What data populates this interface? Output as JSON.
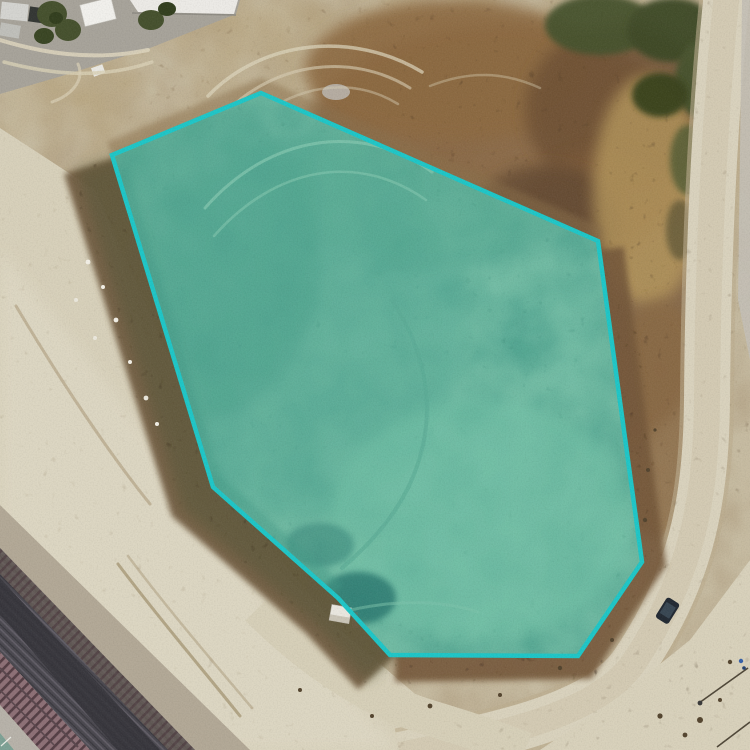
{
  "map": {
    "view": "aerial-orthophoto",
    "overlay": {
      "label": "highlighted-parcel",
      "shape": "polygon",
      "vertex_count": 8,
      "points": "261,93 598,241 642,562 578,656 390,655 338,598 213,487 112,155",
      "stroke_color": "#1fc6c7",
      "stroke_width": 4.5,
      "fill_color": "#2ec8bf",
      "fill_opacity": 0.28
    },
    "palette": {
      "sand": "#d7d0ba",
      "dirt": "#c6bba1",
      "scrub_brown": "#7c5c3b",
      "parcel_green": "#84b094",
      "rail_dark": "#4b4950"
    },
    "imagery_features": [
      "dirt-scrubland",
      "perimeter-dirt-road",
      "railroad-tracks",
      "industrial-yard",
      "parked-vehicle",
      "shed",
      "power-pole-shadows"
    ]
  }
}
